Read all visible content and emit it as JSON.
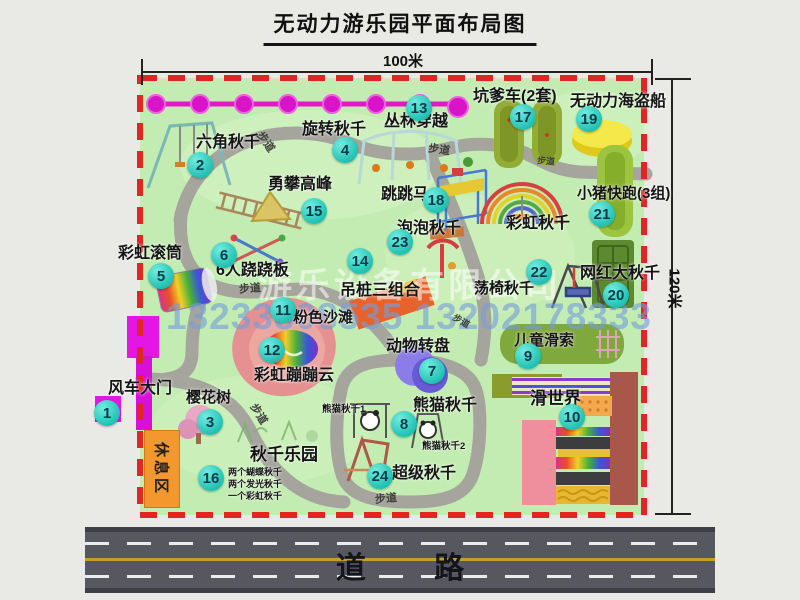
{
  "title": "无动力游乐园平面布局图",
  "dimensions": {
    "width": "100米",
    "height": "120米"
  },
  "watermark": {
    "company": "游乐设备有限公司",
    "phone": "13233808535 13202178333"
  },
  "road_label": "道 路",
  "rest_area_label": "休息区",
  "walkway_label": "步道",
  "attractions": [
    {
      "num": "1",
      "label": "风车大门"
    },
    {
      "num": "2",
      "label": "六角秋千"
    },
    {
      "num": "3",
      "label": "樱花树"
    },
    {
      "num": "4",
      "label": "旋转秋千"
    },
    {
      "num": "5",
      "label": "彩虹滚筒"
    },
    {
      "num": "6",
      "label": "6人跷跷板"
    },
    {
      "num": "7",
      "label": "动物转盘"
    },
    {
      "num": "8",
      "label": "熊猫秋千"
    },
    {
      "num": "9",
      "label": "儿童滑索"
    },
    {
      "num": "10",
      "label": "滑世界"
    },
    {
      "num": "11",
      "label": "粉色沙滩"
    },
    {
      "num": "12",
      "label": "彩虹蹦蹦云"
    },
    {
      "num": "13",
      "label": "丛林穿越"
    },
    {
      "num": "14",
      "label": "吊桩三组合"
    },
    {
      "num": "15",
      "label": "勇攀高峰"
    },
    {
      "num": "16",
      "label": "秋千乐园"
    },
    {
      "num": "17",
      "label": "坑爹车(2套)"
    },
    {
      "num": "18",
      "label": "跳跳马"
    },
    {
      "num": "19",
      "label": "无动力海盗船"
    },
    {
      "num": "20",
      "label": "网红大秋千"
    },
    {
      "num": "21",
      "label": "小猪快跑(3组)"
    },
    {
      "num": "22",
      "label": "荡椅秋千"
    },
    {
      "num": "23",
      "label": "泡泡秋千"
    },
    {
      "num": "24",
      "label": "超级秋千"
    }
  ],
  "unnumbered": {
    "rainbow_swing": "彩虹秋千",
    "panda_swing_1": "熊猫秋千1",
    "panda_swing_2": "熊猫秋千2"
  },
  "swing_park_notes": [
    "两个蝴蝶秋千",
    "两个发光秋千",
    "一个彩虹秋千"
  ],
  "colors": {
    "map_green": "#c3ecb2",
    "border_red": "#e12424",
    "badge_teal": "#1fc0b2",
    "gate_magenta": "#e316e3",
    "rest_orange": "#f2982e",
    "road_gray": "#575760",
    "path_gray": "#a5a59d"
  }
}
